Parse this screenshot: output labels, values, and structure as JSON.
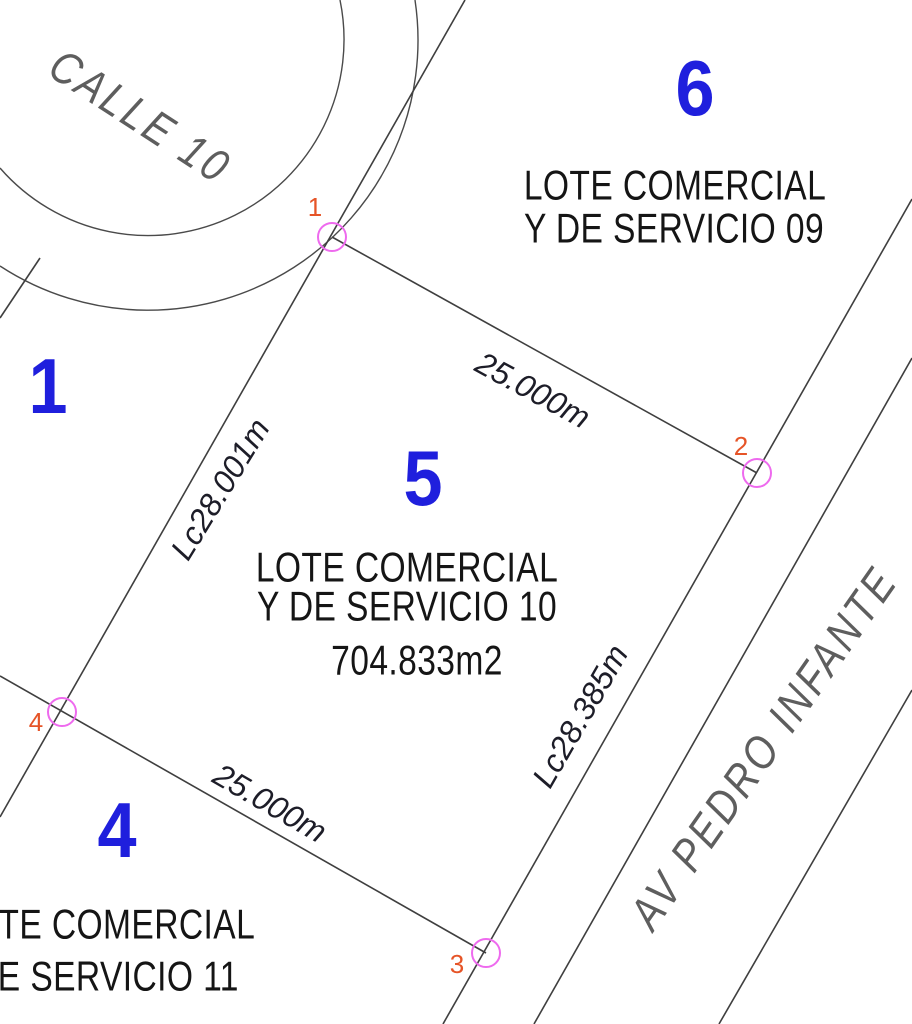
{
  "streets": {
    "curve_street": "CALLE 10",
    "avenue": "AV PEDRO INFANTE"
  },
  "lots": {
    "lot1": {
      "number": "1"
    },
    "lot4": {
      "number": "4",
      "line1": "LOTE COMERCIAL",
      "line2": "Y DE SERVICIO 11"
    },
    "lot5": {
      "number": "5",
      "line1": "LOTE COMERCIAL",
      "line2": "Y DE SERVICIO 10",
      "area": "704.833m2"
    },
    "lot6": {
      "number": "6",
      "line1": "LOTE COMERCIAL",
      "line2": "Y DE SERVICIO 09"
    }
  },
  "dimensions": {
    "north": "25.000m",
    "south": "25.000m",
    "west": "Lc28.001m",
    "east": "Lc28.385m"
  },
  "vertices": {
    "v1": "1",
    "v2": "2",
    "v3": "3",
    "v4": "4"
  },
  "colors": {
    "lot_number_blue": "#1f1fdd",
    "vertex_label_orange": "#e65427",
    "vertex_marker_magenta": "#ee6aee",
    "parcel_text_black": "#151515",
    "dimension_text": "#1d1d28",
    "street_text_gray": "#5e5e5e",
    "boundary_line": "#3f3f3f"
  }
}
